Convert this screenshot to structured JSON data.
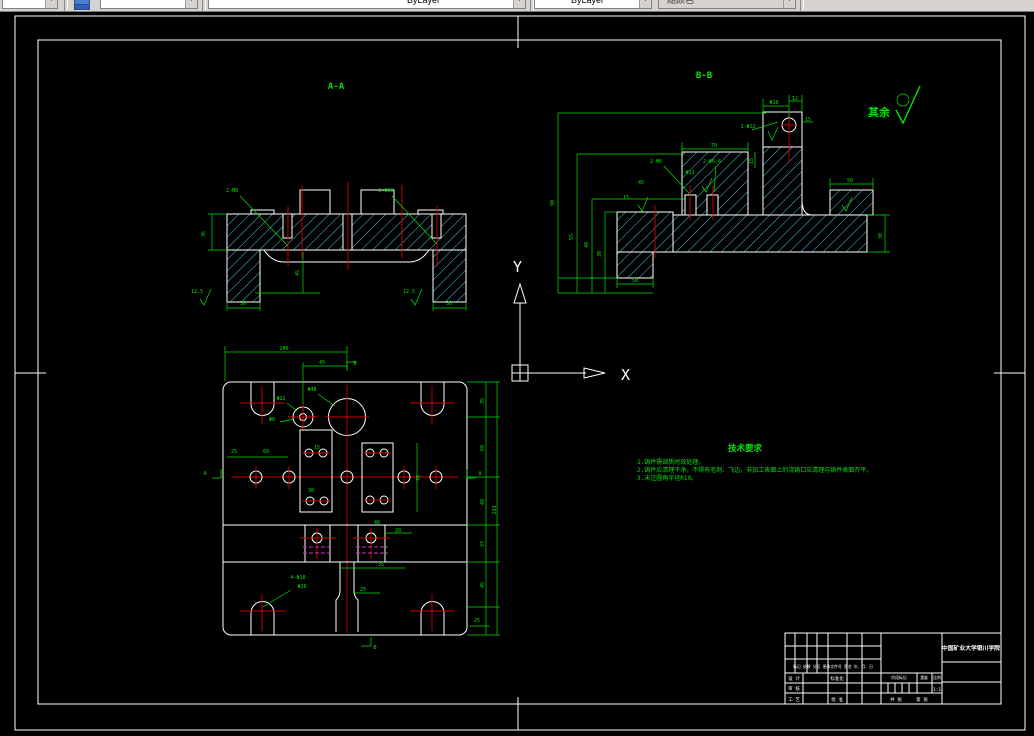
{
  "toolbar": {
    "color_value": "ByLayer",
    "linetype_value": "ByLayer",
    "plot_style_value": "随颜色"
  },
  "drawing": {
    "section_a_label": "A-A",
    "section_b_label": "B-B",
    "surface_default_label": "其余",
    "ucs": {
      "x": "X",
      "y": "Y"
    },
    "tech_requirements": {
      "title": "技术要求",
      "items": [
        "1.铸件需调质时效处理。",
        "2.铸件应清理干净，不得有毛刺、飞边，非加工表面上的浇铸口应清理与铸件表面齐平。",
        "3.未注圆角半径R10。"
      ]
    }
  },
  "title_block": {
    "school": "中国矿业大学银川学院",
    "revision_header": "标记 处数 分区 更改文件号 签名 年、月、日",
    "design": "设 计",
    "standardization": "标准化",
    "check": "审 核",
    "process": "工 艺",
    "approve": "批 准",
    "stage_mark": "阶段标记",
    "weight": "重量",
    "scale": "比例",
    "scale_value": "1:1",
    "sheet_total": "共 张",
    "sheet_index": "第 张"
  },
  "colors": {
    "outline": "#ffffff",
    "hatch": "#45c6dc",
    "dimension": "#00e400",
    "centerline": "#d40000",
    "hidden": "#cf30cf",
    "canvas": "#000000",
    "toolbar_bg": "#d6d3ce"
  },
  "dim_labels": [
    {
      "t": "36",
      "x": 205,
      "y": 234,
      "r": -90
    },
    {
      "t": "30",
      "x": 243,
      "y": 305
    },
    {
      "t": "30",
      "x": 449,
      "y": 305
    },
    {
      "t": "2-M8",
      "x": 232,
      "y": 192
    },
    {
      "t": "2-Φ10",
      "x": 386,
      "y": 192
    },
    {
      "t": "12.5",
      "x": 197,
      "y": 293
    },
    {
      "t": "12.5",
      "x": 409,
      "y": 293
    },
    {
      "t": "45",
      "x": 299,
      "y": 273,
      "r": -90
    },
    {
      "t": "90",
      "x": 554,
      "y": 203,
      "r": -90
    },
    {
      "t": "55",
      "x": 573,
      "y": 237,
      "r": -90
    },
    {
      "t": "40",
      "x": 588,
      "y": 245,
      "r": -90
    },
    {
      "t": "30",
      "x": 601,
      "y": 254,
      "r": -90
    },
    {
      "t": "Φ10",
      "x": 774,
      "y": 104
    },
    {
      "t": "12",
      "x": 795,
      "y": 100
    },
    {
      "t": "15",
      "x": 808,
      "y": 121
    },
    {
      "t": "1-Φ12",
      "x": 748,
      "y": 128
    },
    {
      "t": "70",
      "x": 714,
      "y": 147
    },
    {
      "t": "15",
      "x": 753,
      "y": 161,
      "r": -90
    },
    {
      "t": "2-M6",
      "x": 656,
      "y": 163
    },
    {
      "t": "2-Φ6.6",
      "x": 712,
      "y": 163
    },
    {
      "t": "Φ12",
      "x": 690,
      "y": 174
    },
    {
      "t": "45",
      "x": 641,
      "y": 184
    },
    {
      "t": "15",
      "x": 626,
      "y": 199
    },
    {
      "t": "50",
      "x": 635,
      "y": 282
    },
    {
      "t": "50",
      "x": 850,
      "y": 182
    },
    {
      "t": "30",
      "x": 882,
      "y": 236,
      "r": -90
    },
    {
      "t": "200",
      "x": 284,
      "y": 350
    },
    {
      "t": "45",
      "x": 322,
      "y": 364
    },
    {
      "t": "Φ48",
      "x": 312,
      "y": 391
    },
    {
      "t": "Φ22",
      "x": 281,
      "y": 400
    },
    {
      "t": "Φ8",
      "x": 272,
      "y": 421
    },
    {
      "t": "25",
      "x": 234,
      "y": 453
    },
    {
      "t": "60",
      "x": 266,
      "y": 453
    },
    {
      "t": "15",
      "x": 317,
      "y": 449
    },
    {
      "t": "30",
      "x": 311,
      "y": 492
    },
    {
      "t": "70",
      "x": 420,
      "y": 478,
      "r": -90
    },
    {
      "t": "20",
      "x": 398,
      "y": 532
    },
    {
      "t": "40",
      "x": 377,
      "y": 524
    },
    {
      "t": "35",
      "x": 381,
      "y": 566
    },
    {
      "t": "25",
      "x": 363,
      "y": 591
    },
    {
      "t": "4-Φ18",
      "x": 298,
      "y": 579
    },
    {
      "t": "Φ26",
      "x": 302,
      "y": 588
    },
    {
      "t": "35",
      "x": 484,
      "y": 401,
      "r": -90
    },
    {
      "t": "60",
      "x": 484,
      "y": 448,
      "r": -90
    },
    {
      "t": "48",
      "x": 484,
      "y": 502,
      "r": -90
    },
    {
      "t": "37",
      "x": 484,
      "y": 544,
      "r": -90
    },
    {
      "t": "45",
      "x": 484,
      "y": 585,
      "r": -90
    },
    {
      "t": "253",
      "x": 496,
      "y": 510,
      "r": -90
    },
    {
      "t": "25",
      "x": 477,
      "y": 622
    },
    {
      "t": "A",
      "x": 205,
      "y": 475
    },
    {
      "t": "A",
      "x": 480,
      "y": 475
    },
    {
      "t": "B",
      "x": 355,
      "y": 365
    },
    {
      "t": "B",
      "x": 375,
      "y": 649
    }
  ]
}
